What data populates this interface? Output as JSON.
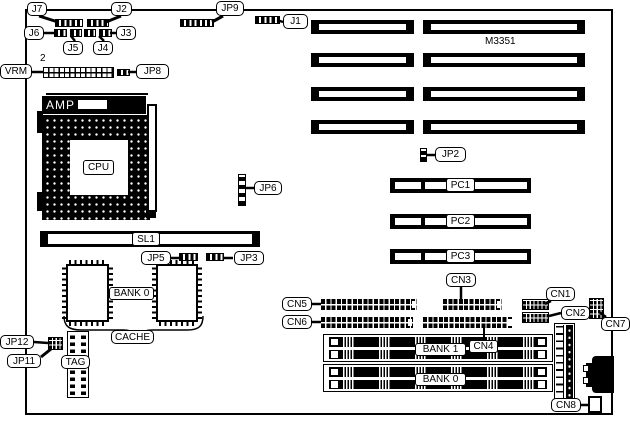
{
  "board": {
    "model": "M3351",
    "vrm_pin": "2"
  },
  "labels": {
    "j1": "J1",
    "j2": "J2",
    "j3": "J3",
    "j4": "J4",
    "j5": "J5",
    "j6": "J6",
    "j7": "J7",
    "jp2": "JP2",
    "jp3": "JP3",
    "jp5": "JP5",
    "jp6": "JP6",
    "jp8": "JP8",
    "jp9": "JP9",
    "jp11": "JP11",
    "jp12": "JP12",
    "vrm": "VRM",
    "amp": "AMP",
    "cpu": "CPU",
    "sl1": "SL1",
    "cache_bank": "BANK 0",
    "cache": "CACHE",
    "tag": "TAG",
    "pc1": "PC1",
    "pc2": "PC2",
    "pc3": "PC3",
    "cn1": "CN1",
    "cn2": "CN2",
    "cn3": "CN3",
    "cn4": "CN4",
    "cn5": "CN5",
    "cn6": "CN6",
    "cn7": "CN7",
    "cn8": "CN8",
    "bank1": "BANK 1",
    "bank0": "BANK 0"
  }
}
